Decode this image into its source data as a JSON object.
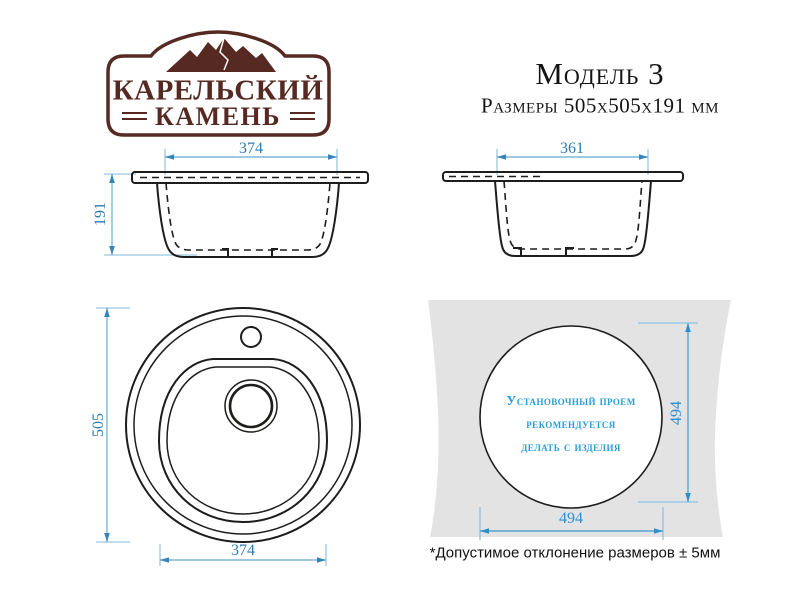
{
  "brand": {
    "name_line1": "КАРЕЛЬСКИЙ",
    "name_line2": "КАМЕНЬ",
    "color": "#562a22"
  },
  "header": {
    "model": "Модель 3",
    "size": "Размеры 505x505x191 мм"
  },
  "front_view": {
    "top_width_mm": "374",
    "height_mm": "191"
  },
  "side_view": {
    "top_width_mm": "361"
  },
  "top_view": {
    "outer_diameter_mm": "505",
    "bowl_width_mm": "374"
  },
  "cutout_view": {
    "note_line1": "Установочный проем",
    "note_line2": "рекомендуется",
    "note_line3": "делать с изделия",
    "height_mm": "494",
    "width_mm": "494"
  },
  "footnote": {
    "text": "*Допустимое отклонение размеров ± 5мм"
  },
  "colors": {
    "line": "#1d1d1b",
    "dimension_line": "#7db8d9",
    "dimension_text": "#2f7cb3",
    "cutout_dimension": "#2e8fce",
    "cutout_note_text": "#2b9cd8",
    "countertop_panel": "#e3e3e3",
    "brand_brown": "#562a22",
    "background": "#ffffff"
  }
}
